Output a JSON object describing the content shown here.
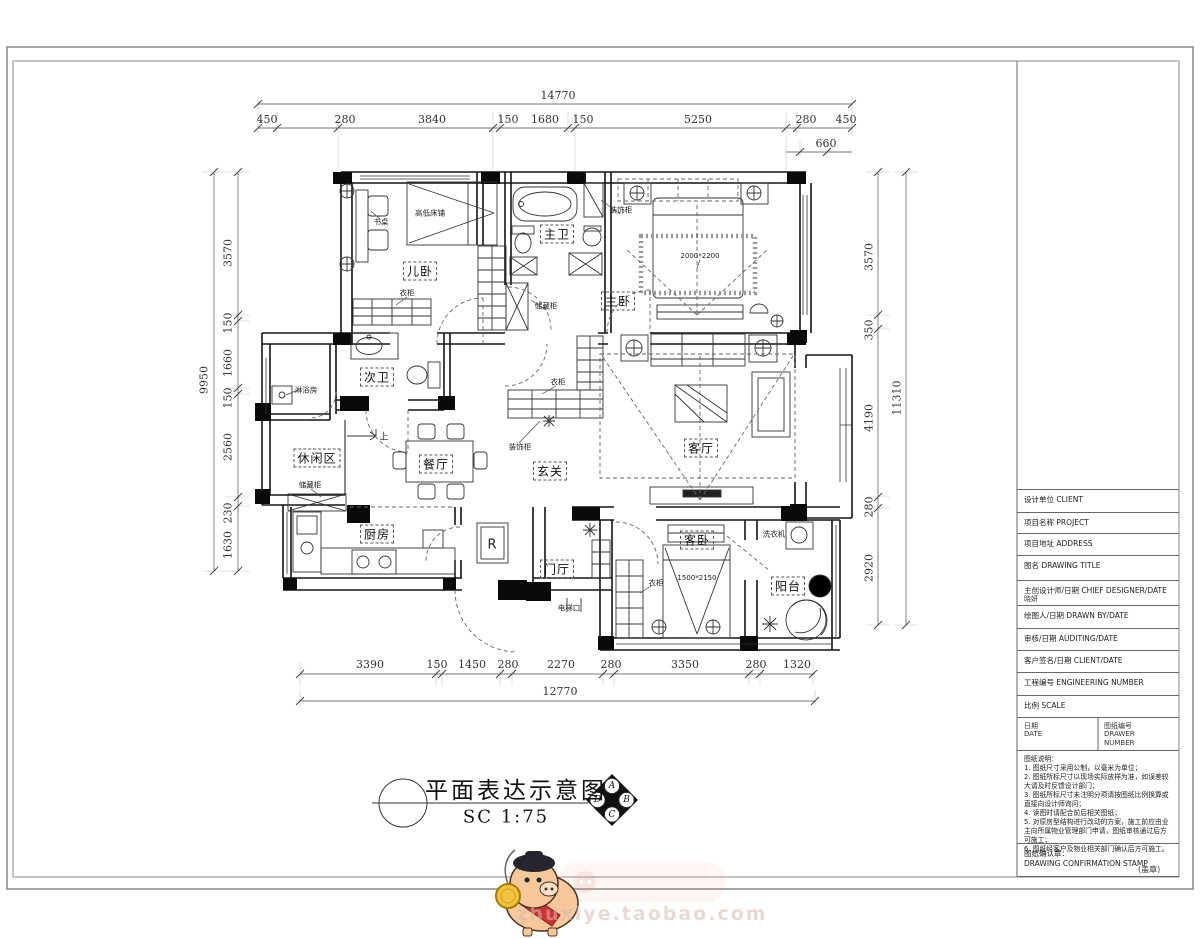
{
  "rooms": {
    "er_wo": "儿卧",
    "zhu_wei": "主卫",
    "zhu_wo": "主卧",
    "ci_wei": "次卫",
    "xiu_xian": "休闲区",
    "can_ting": "餐厅",
    "xuan_guan": "玄关",
    "ke_ting": "客厅",
    "chu_fang": "厨房",
    "men_ting": "门厅",
    "ke_wo": "客卧",
    "yang_tai": "阳台"
  },
  "ann": {
    "bunk": "高低床铺",
    "desk": "书桌",
    "ward1": "衣柜",
    "store1": "储藏柜",
    "deco1": "装饰柜",
    "shower": "淋浴房",
    "store2": "储藏柜",
    "ward2": "衣柜",
    "deco2": "装饰柜",
    "ward3": "衣柜",
    "washer": "洗衣机",
    "elevator": "电梯口",
    "up": "上",
    "fridge": "R",
    "bed_main": "2000*2200",
    "bed_guest": "1500*2150"
  },
  "dims": {
    "top": {
      "total": "14770",
      "segs": [
        "450",
        "280",
        "3840",
        "150",
        "1680",
        "150",
        "5250",
        "280",
        "450"
      ],
      "sub": "660"
    },
    "bottom": {
      "total": "12770",
      "segs": [
        "3390",
        "150",
        "1450",
        "280",
        "2270",
        "280",
        "3350",
        "280",
        "1320"
      ]
    },
    "left": {
      "total": "9950",
      "segs": [
        "3570",
        "150",
        "1660",
        "150",
        "2560",
        "230",
        "1630"
      ]
    },
    "right": {
      "total": "11310",
      "segs": [
        "3570",
        "350",
        "4190",
        "280",
        "2920"
      ]
    }
  },
  "tb": {
    "rows": [
      "设计单位 CLIENT",
      "项目名称 PROJECT",
      "项目地址 ADDRESS",
      "图名 DRAWING TITLE",
      "主创设计师/日期 CHIEF DESIGNER/DATE",
      "绘图人/日期 DRAWN BY/DATE",
      "审核/日期 AUDITING/DATE",
      "客户签名/日期 CLIENT/DATE",
      "工程编号 ENGINEERING NUMBER",
      "比例 SCALE"
    ],
    "designer": "晓妍",
    "date_cn": "日期",
    "date_en": "DATE",
    "num_cn": "图纸编号",
    "num_en1": "DRAWER",
    "num_en2": "NUMBER",
    "notes_title": "图纸说明：",
    "notes": [
      "1. 图纸尺寸采用公制，以毫米为单位；",
      "2. 图纸所标尺寸以现场实际放样为准，如误差较大请及时反馈设计部门；",
      "3. 图纸所标尺寸未注明分项请按图纸比例换算或直接向设计师询问；",
      "4. 读图时请配合前后相关图纸；",
      "5. 对原房型结构进行改动的方案，施工前应由业主向所属物业管理部门申请，图纸审核通过后方可施工；",
      "6. 图纸经客户及物业相关部门确认后方可施工。"
    ],
    "stamp_cn": "图纸确认章：",
    "stamp_en": "DRAWING CONFIRMATION STAMP",
    "seal": "(盖章)"
  },
  "caption": {
    "title": "平面表达示意图",
    "scale": "SC  1:75",
    "compass": [
      "A",
      "B",
      "C",
      "D"
    ]
  },
  "watermark": {
    "url": "zhuxiye.taobao.com"
  }
}
